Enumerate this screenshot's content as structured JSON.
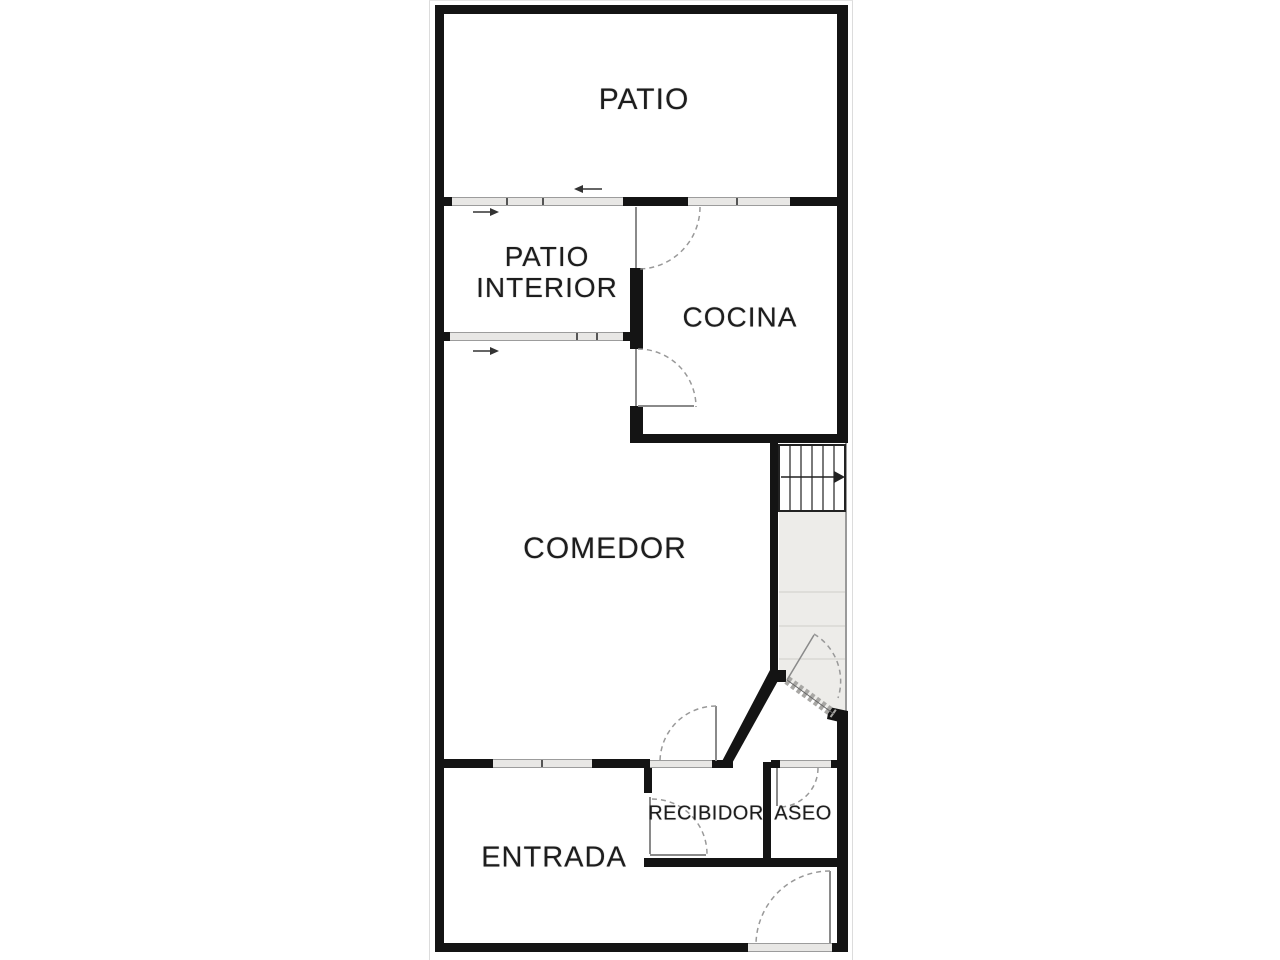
{
  "title": "Floor plan",
  "rooms": {
    "patio": "PATIO",
    "patio_interior": "PATIO INTERIOR",
    "cocina": "COCINA",
    "comedor": "COMEDOR",
    "recibidor": "RECIBIDOR",
    "aseo": "ASEO",
    "entrada": "ENTRADA"
  },
  "colors": {
    "wall": "#141414",
    "window-band": "#e8e7e5",
    "corridor-fill": "#edece9",
    "arc-line": "#999999",
    "leaf-line": "#8a8a8a"
  }
}
